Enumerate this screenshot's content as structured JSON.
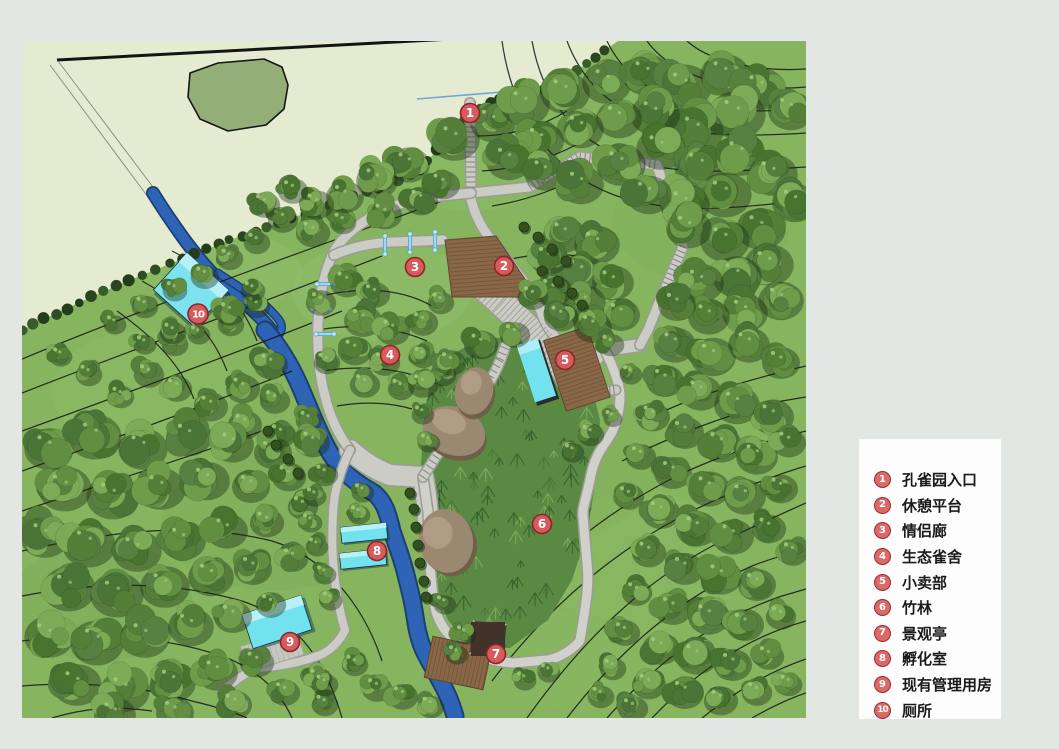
{
  "legend": {
    "items": [
      {
        "num": "1",
        "label": "孔雀园入口"
      },
      {
        "num": "2",
        "label": "休憩平台"
      },
      {
        "num": "3",
        "label": "情侣廊"
      },
      {
        "num": "4",
        "label": "生态雀舍"
      },
      {
        "num": "5",
        "label": "小卖部"
      },
      {
        "num": "6",
        "label": "竹林"
      },
      {
        "num": "7",
        "label": "景观亭"
      },
      {
        "num": "8",
        "label": "孵化室"
      },
      {
        "num": "9",
        "label": "现有管理用房"
      },
      {
        "num": "10",
        "label": "厕所"
      }
    ]
  },
  "map": {
    "markers": [
      {
        "num": "1",
        "x": 448,
        "y": 72
      },
      {
        "num": "2",
        "x": 482,
        "y": 225
      },
      {
        "num": "3",
        "x": 393,
        "y": 226
      },
      {
        "num": "4",
        "x": 368,
        "y": 314
      },
      {
        "num": "5",
        "x": 543,
        "y": 319
      },
      {
        "num": "6",
        "x": 520,
        "y": 483
      },
      {
        "num": "7",
        "x": 474,
        "y": 613
      },
      {
        "num": "8",
        "x": 355,
        "y": 510
      },
      {
        "num": "9",
        "x": 268,
        "y": 601
      },
      {
        "num": "10",
        "x": 176,
        "y": 273
      }
    ]
  },
  "colors": {
    "marker_fill": "#d45c5c",
    "marker_border": "#8e2424",
    "marker_text": "#ffffff",
    "grass": "#86b45f",
    "outside_site": "#e4ebd1",
    "pond": "#93ae76",
    "river": "#2f63b6",
    "path": "#cbccc5",
    "building_cyan": "#73e2ef",
    "wood_deck": "#8a6847",
    "bamboo": "#5a8943",
    "contour": "#161616",
    "page_background": "#e2e7e3",
    "legend_background": "#fdfdfd"
  }
}
